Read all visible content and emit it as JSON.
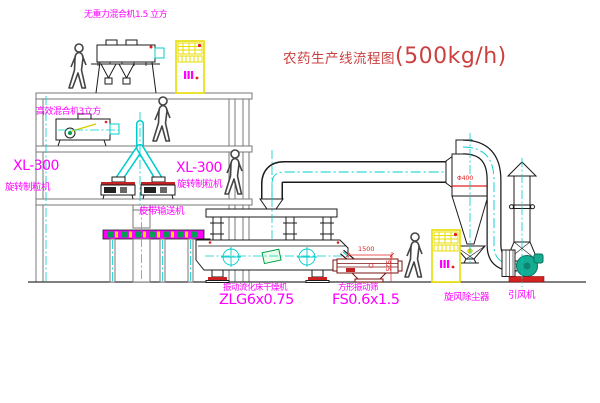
{
  "title": {
    "name": "农药生产线流程图",
    "capacity": "(500kg/h)"
  },
  "labels": {
    "top_mixer": "无重力混合机1.5 立方",
    "mid_mixer": "高效混合机3立方",
    "granulator_left_model": "XL-300",
    "granulator_left_name": "旋转制粒机",
    "granulator_mid_model": "XL-300",
    "granulator_mid_name": "旋转制粒机",
    "belt_conveyor": "皮带输送机",
    "fluid_bed_dryer_name": "振动流化床干燥机",
    "fluid_bed_dryer_model": "ZLG6x0.75",
    "vibrating_sieve_name": "方形振动筛",
    "vibrating_sieve_model": "FS0.6x1.5",
    "cyclone_dust_collector": "旋风除尘器",
    "induced_draft_fan": "引风机"
  },
  "dimensions": {
    "sieve_length": "1500",
    "sieve_height": "525",
    "cyclone_diameter": "Φ400"
  },
  "colors": {
    "label_magenta": "#ff00ff",
    "title_red": "#cc4040",
    "dimension_red": "#e02020",
    "centerline_cyan": "#00cccc",
    "cabinet_yellow": "#e8de00",
    "machine_line": "#1b1b1b",
    "structure_gray": "#777777",
    "fan_green": "#14ad92"
  }
}
